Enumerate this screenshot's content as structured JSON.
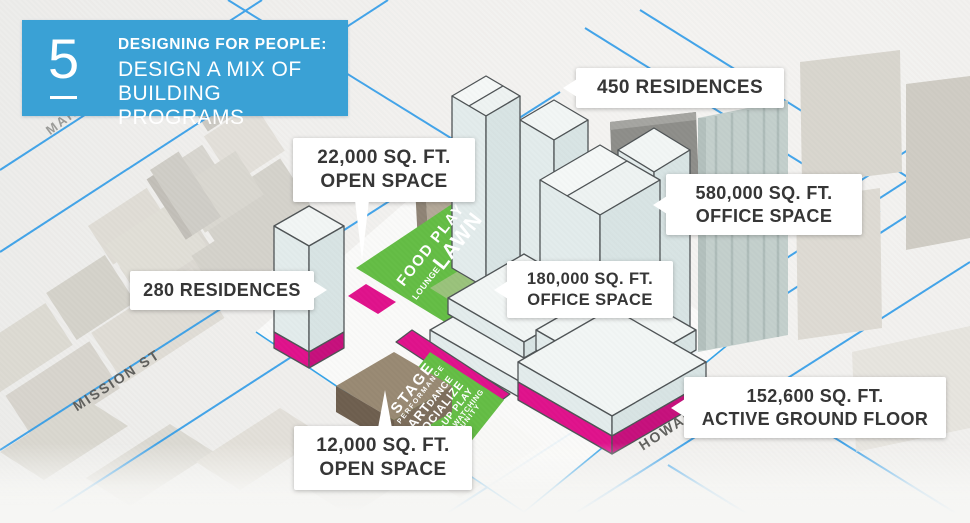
{
  "slide": {
    "step_number": "5",
    "kicker": "DESIGNING FOR PEOPLE:",
    "title_line1": "DESIGN A MIX OF",
    "title_line2": "BUILDING PROGRAMS"
  },
  "streets": {
    "market": "MARKET ST",
    "mission": "MISSION ST",
    "howard": "HOWARD"
  },
  "callouts": {
    "open_space_22k": {
      "line1": "22,000 SQ. FT.",
      "line2": "OPEN SPACE"
    },
    "residences_450": {
      "line1": "450 RESIDENCES"
    },
    "office_580k": {
      "line1": "580,000 SQ. FT.",
      "line2": "OFFICE SPACE"
    },
    "residences_280": {
      "line1": "280 RESIDENCES"
    },
    "office_180k": {
      "line1": "180,000 SQ. FT.",
      "line2": "OFFICE SPACE"
    },
    "active_ground_152k": {
      "line1": "152,600 SQ. FT.",
      "line2": "ACTIVE GROUND FLOOR"
    },
    "open_space_12k": {
      "line1": "12,000 SQ. FT.",
      "line2": "OPEN SPACE"
    }
  },
  "lawn_labels": {
    "l1a": "FOOD PLAY",
    "l2_small": "LOUNGE",
    "l2_big": "LAWN"
  },
  "plaza_labels": {
    "w1": "STAGE",
    "w2": "PERFORMANCE",
    "w3a": "ART",
    "w3b": "DANCE",
    "w4": "SOCIALIZE",
    "w5": "POP-UP PLAY",
    "w6": "PEOPLE WATCHING",
    "w7": "COMMUNITY"
  },
  "colors": {
    "header_blue": "#3aa1d5",
    "street_line_blue": "#2f9ce8",
    "open_space_green": "#64bd45",
    "active_ground_magenta": "#e0128c",
    "callout_text": "#363636",
    "massing_top": "#f2f6f5",
    "massing_side": "#dce7e7"
  }
}
